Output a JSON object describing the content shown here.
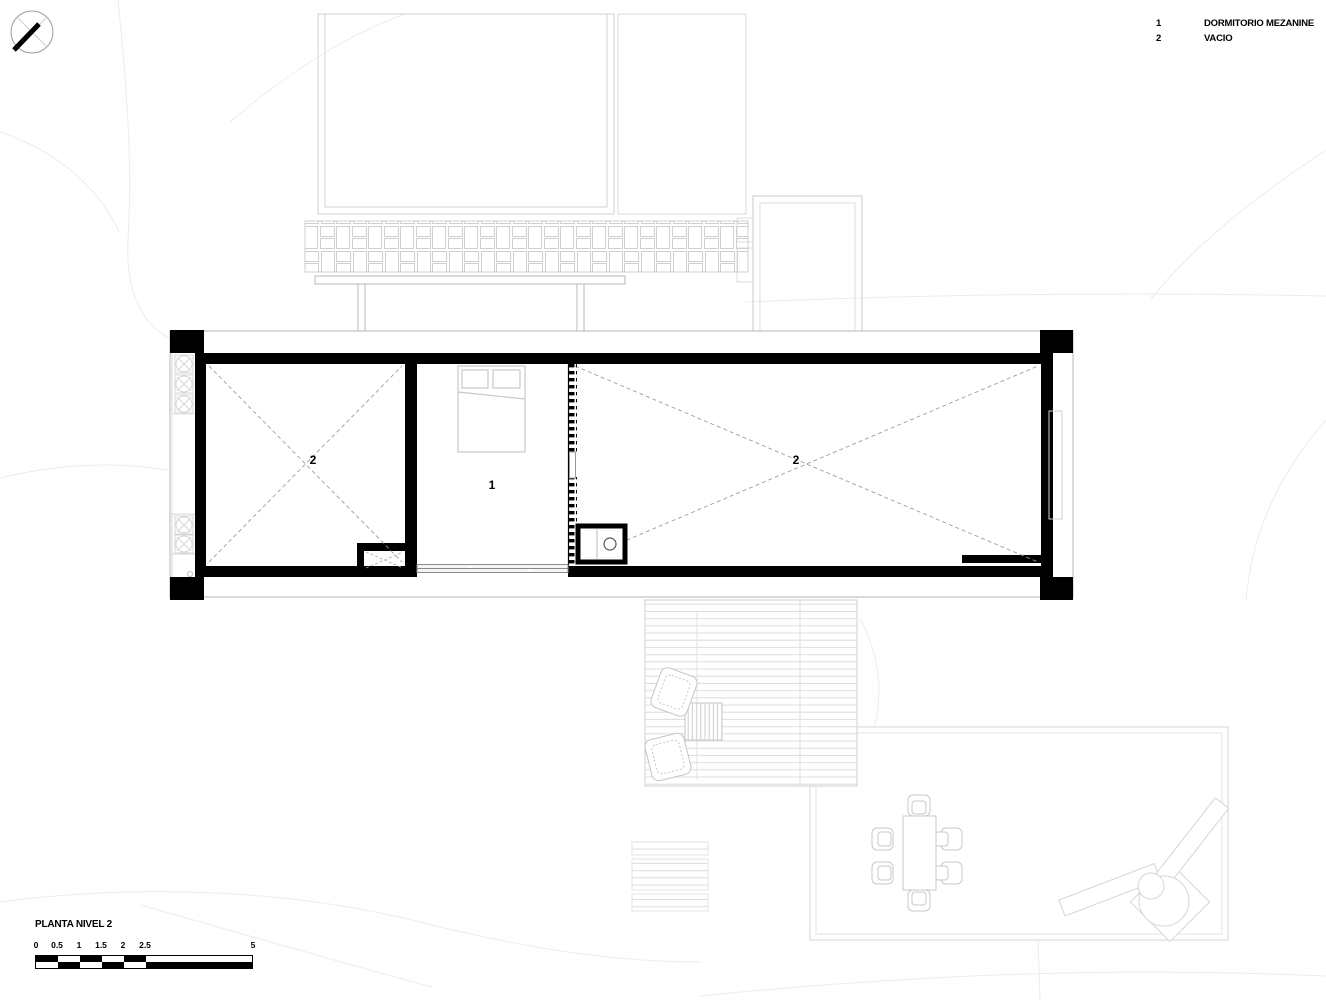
{
  "page": {
    "title": "PLANTA NIVEL 2"
  },
  "legend": {
    "items": [
      {
        "number": "1",
        "label": "DORMITORIO MEZANINE"
      },
      {
        "number": "2",
        "label": "VACIO"
      }
    ]
  },
  "plan": {
    "labels": {
      "left_void": "2",
      "bedroom": "1",
      "right_void": "2"
    }
  },
  "scale_bar": {
    "ticks": [
      "0",
      "0.5",
      "1",
      "1.5",
      "2",
      "2.5",
      "5"
    ]
  },
  "icons": {
    "compass": "north-arrow-icon"
  },
  "colors": {
    "ink": "#000000",
    "furniture": "#c8c8c8",
    "contour": "#ececec"
  }
}
